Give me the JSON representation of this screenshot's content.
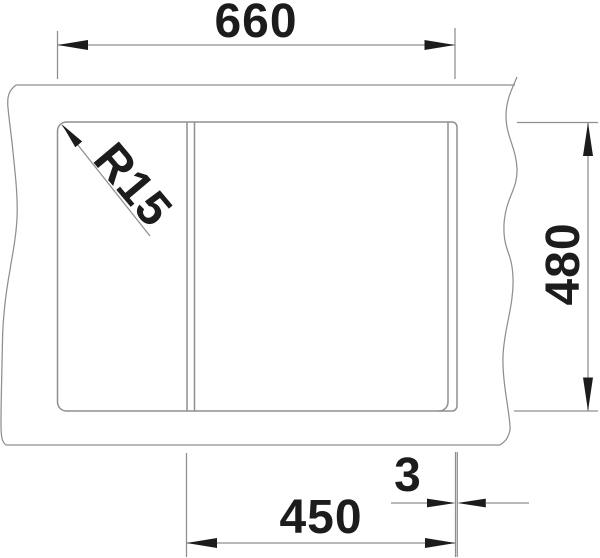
{
  "drawing": {
    "labels": {
      "overall_width": "660",
      "overall_depth": "480",
      "bowl_width": "450",
      "rim_gap": "3",
      "corner_radius": "R15"
    },
    "colors": {
      "line": "#8f8f8f",
      "ink": "#1c1c1c",
      "background": "#ffffff"
    }
  }
}
